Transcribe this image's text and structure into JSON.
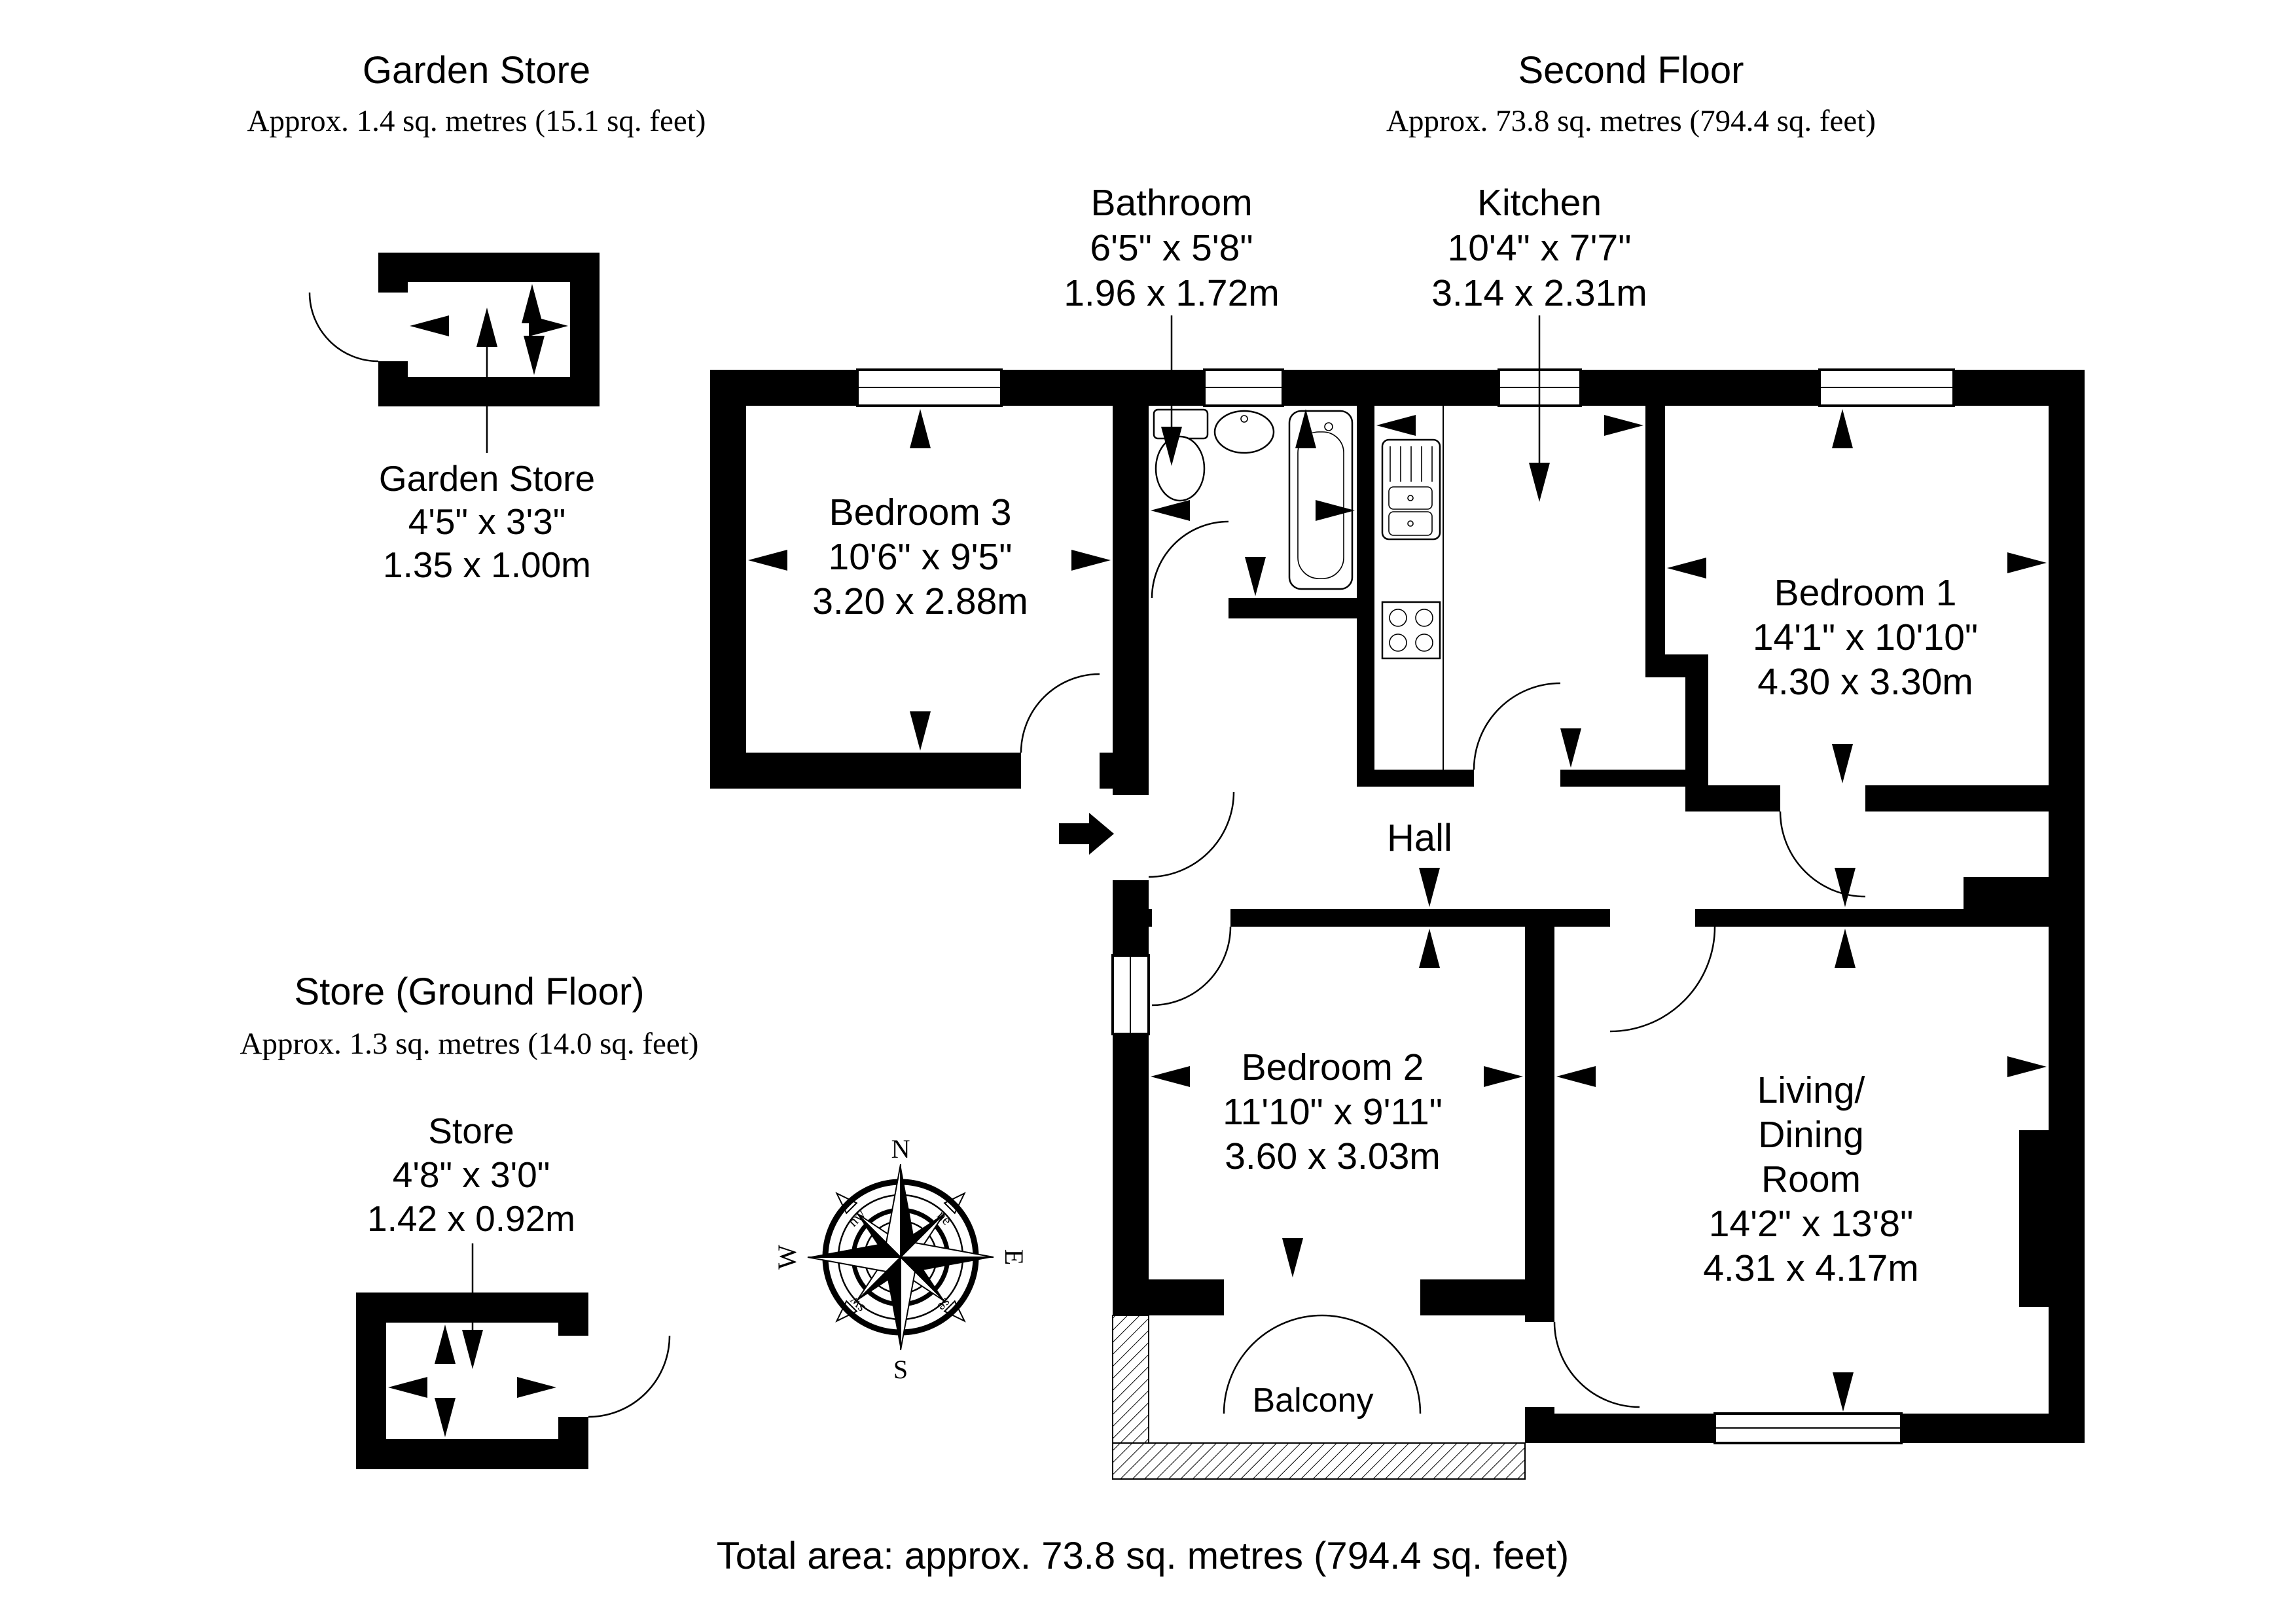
{
  "headers": {
    "garden_store": {
      "title": "Garden Store",
      "subtitle": "Approx. 1.4 sq. metres (15.1 sq. feet)"
    },
    "second_floor": {
      "title": "Second Floor",
      "subtitle": "Approx. 73.8 sq. metres (794.4 sq. feet)"
    },
    "store_ground": {
      "title": "Store (Ground Floor)",
      "subtitle": "Approx. 1.3 sq. metres (14.0 sq. feet)"
    }
  },
  "rooms": {
    "bedroom3": {
      "name": "Bedroom 3",
      "imperial": "10'6\" x 9'5\"",
      "metric": "3.20 x 2.88m"
    },
    "bathroom": {
      "name": "Bathroom",
      "imperial": "6'5\" x 5'8\"",
      "metric": "1.96 x 1.72m"
    },
    "kitchen": {
      "name": "Kitchen",
      "imperial": "10'4\" x 7'7\"",
      "metric": "3.14 x 2.31m"
    },
    "bedroom1": {
      "name": "Bedroom 1",
      "imperial": "14'1\" x 10'10\"",
      "metric": "4.30 x 3.30m"
    },
    "bedroom2": {
      "name": "Bedroom 2",
      "imperial": "11'10\" x 9'11\"",
      "metric": "3.60 x 3.03m"
    },
    "living": {
      "name1": "Living/",
      "name2": "Dining",
      "name3": "Room",
      "imperial": "14'2\" x 13'8\"",
      "metric": "4.31 x 4.17m"
    },
    "hall": {
      "name": "Hall"
    },
    "balcony": {
      "name": "Balcony"
    }
  },
  "mini_labels": {
    "garden_store": {
      "name": "Garden Store",
      "imperial": "4'5\" x 3'3\"",
      "metric": "1.35 x 1.00m"
    },
    "store": {
      "name": "Store",
      "imperial": "4'8\" x 3'0\"",
      "metric": "1.42 x 0.92m"
    }
  },
  "compass": {
    "n": "N",
    "e": "E",
    "s": "S",
    "w": "W",
    "ne": "ne",
    "nw": "nw",
    "se": "se",
    "sw": "sw"
  },
  "footer": {
    "total_area": "Total area: approx. 73.8 sq. metres (794.4 sq. feet)"
  },
  "colors": {
    "wall": "#000000",
    "background": "#ffffff"
  }
}
